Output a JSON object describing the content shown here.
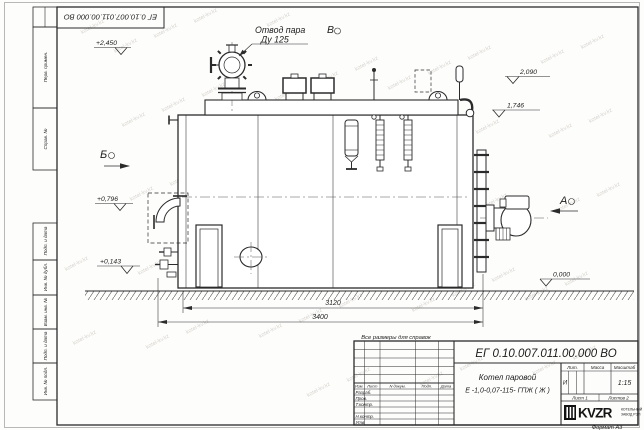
{
  "sheet": {
    "watermark_text": "kotel-kv.kz",
    "format_note": "Формат А3",
    "reference_note": "Все размеры для справок",
    "designation_top": "ЕГ 0.10.007.011.00.000  ВО"
  },
  "left_stamps": {
    "cells": [
      "Перв. примен.",
      "Справ. №",
      "Подп. и дата",
      "Инв. № дубл.",
      "Взам. инв. №",
      "Подп. и дата",
      "Инв. № подл."
    ]
  },
  "drawing": {
    "steam_outlet_label_line1": "Отвод пара",
    "steam_outlet_label_line2": "Ду 125",
    "view_v_top": "В",
    "view_b_left": "Б",
    "view_a_right": "А",
    "level_2450": "+2,450",
    "level_2090": "2,090",
    "level_1746": "1,746",
    "level_0796": "+0,796",
    "level_0143": "+0,143",
    "level_0000": "0,000",
    "dim_inner": "3120",
    "dim_overall": "3400"
  },
  "title_block": {
    "doc_number": "ЕГ 0.10.007.011.00.000  ВО",
    "name_line1": "Котел паровой",
    "name_line2": "Е -1,0-0,07-115- ГПЖ ( Ж )",
    "col_izm": "Изм.",
    "col_list": "Лист",
    "col_doc": "N докум.",
    "col_podp": "Подп.",
    "col_data": "Дата",
    "row_razrab": "Разраб.",
    "row_prov": "Пров.",
    "row_tkontr": "Т.контр.",
    "row_nkontr": "Н.контр.",
    "row_utv": "Утв.",
    "lit_label": "Лит.",
    "lit_value": "И",
    "mass_label": "Масса",
    "scale_label": "Масштаб",
    "scale_value": "1:15",
    "sheet_cell": "Лист 1",
    "sheets_cell": "Листов 2",
    "logo_text": "KVZR",
    "logo_sub1": "КОТЕЛЬНЫЙ",
    "logo_sub2": "ЗАВОД РЭП"
  }
}
